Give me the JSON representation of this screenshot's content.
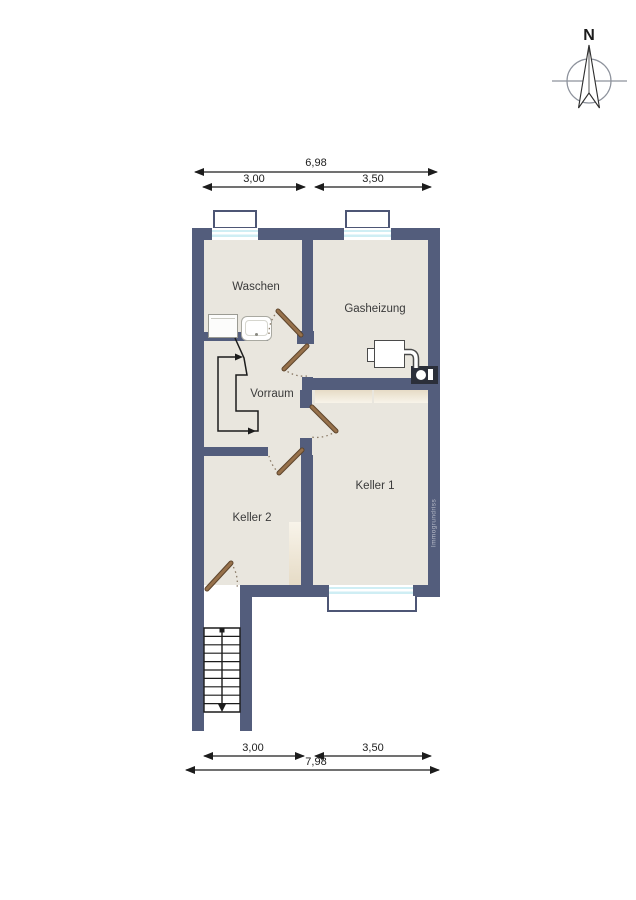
{
  "compass": {
    "label": "N"
  },
  "dimensions": {
    "top": {
      "total": "6,98",
      "segment_left": "3,00",
      "segment_right": "3,50"
    },
    "bottom": {
      "segment_left": "3,00",
      "segment_right": "3,50",
      "total": "7,98"
    }
  },
  "rooms": {
    "waschen": "Waschen",
    "gasheizung": "Gasheizung",
    "vorraum": "Vorraum",
    "keller1": "Keller 1",
    "keller2": "Keller 2"
  },
  "watermark": "Immogrundriss",
  "fixtures": {
    "washer": "washing-machine",
    "basin": "wash-basin",
    "heater": "gas-heater-unit",
    "flue_box": "flue-connection-box",
    "interior_stairs": "staircase-up",
    "exterior_stairs": "exterior-staircase-down",
    "windows": "basement-windows-with-light-wells"
  },
  "colors": {
    "wall": "#535d7c",
    "wall-light": "#9096a8",
    "floor": "#e9e6de",
    "door": "#97714b",
    "door-dark": "#5e452c",
    "glass": "#cfeef4",
    "well-border": "#4d5675",
    "line": "#1c1c1c",
    "label": "#3a3a3a",
    "shelf-top": "#e6dbc6",
    "shelf-bottom": "#f8f4ea",
    "watermark": "#b6bac7",
    "compass": "#8d929c",
    "arc": "#8a7a66"
  }
}
